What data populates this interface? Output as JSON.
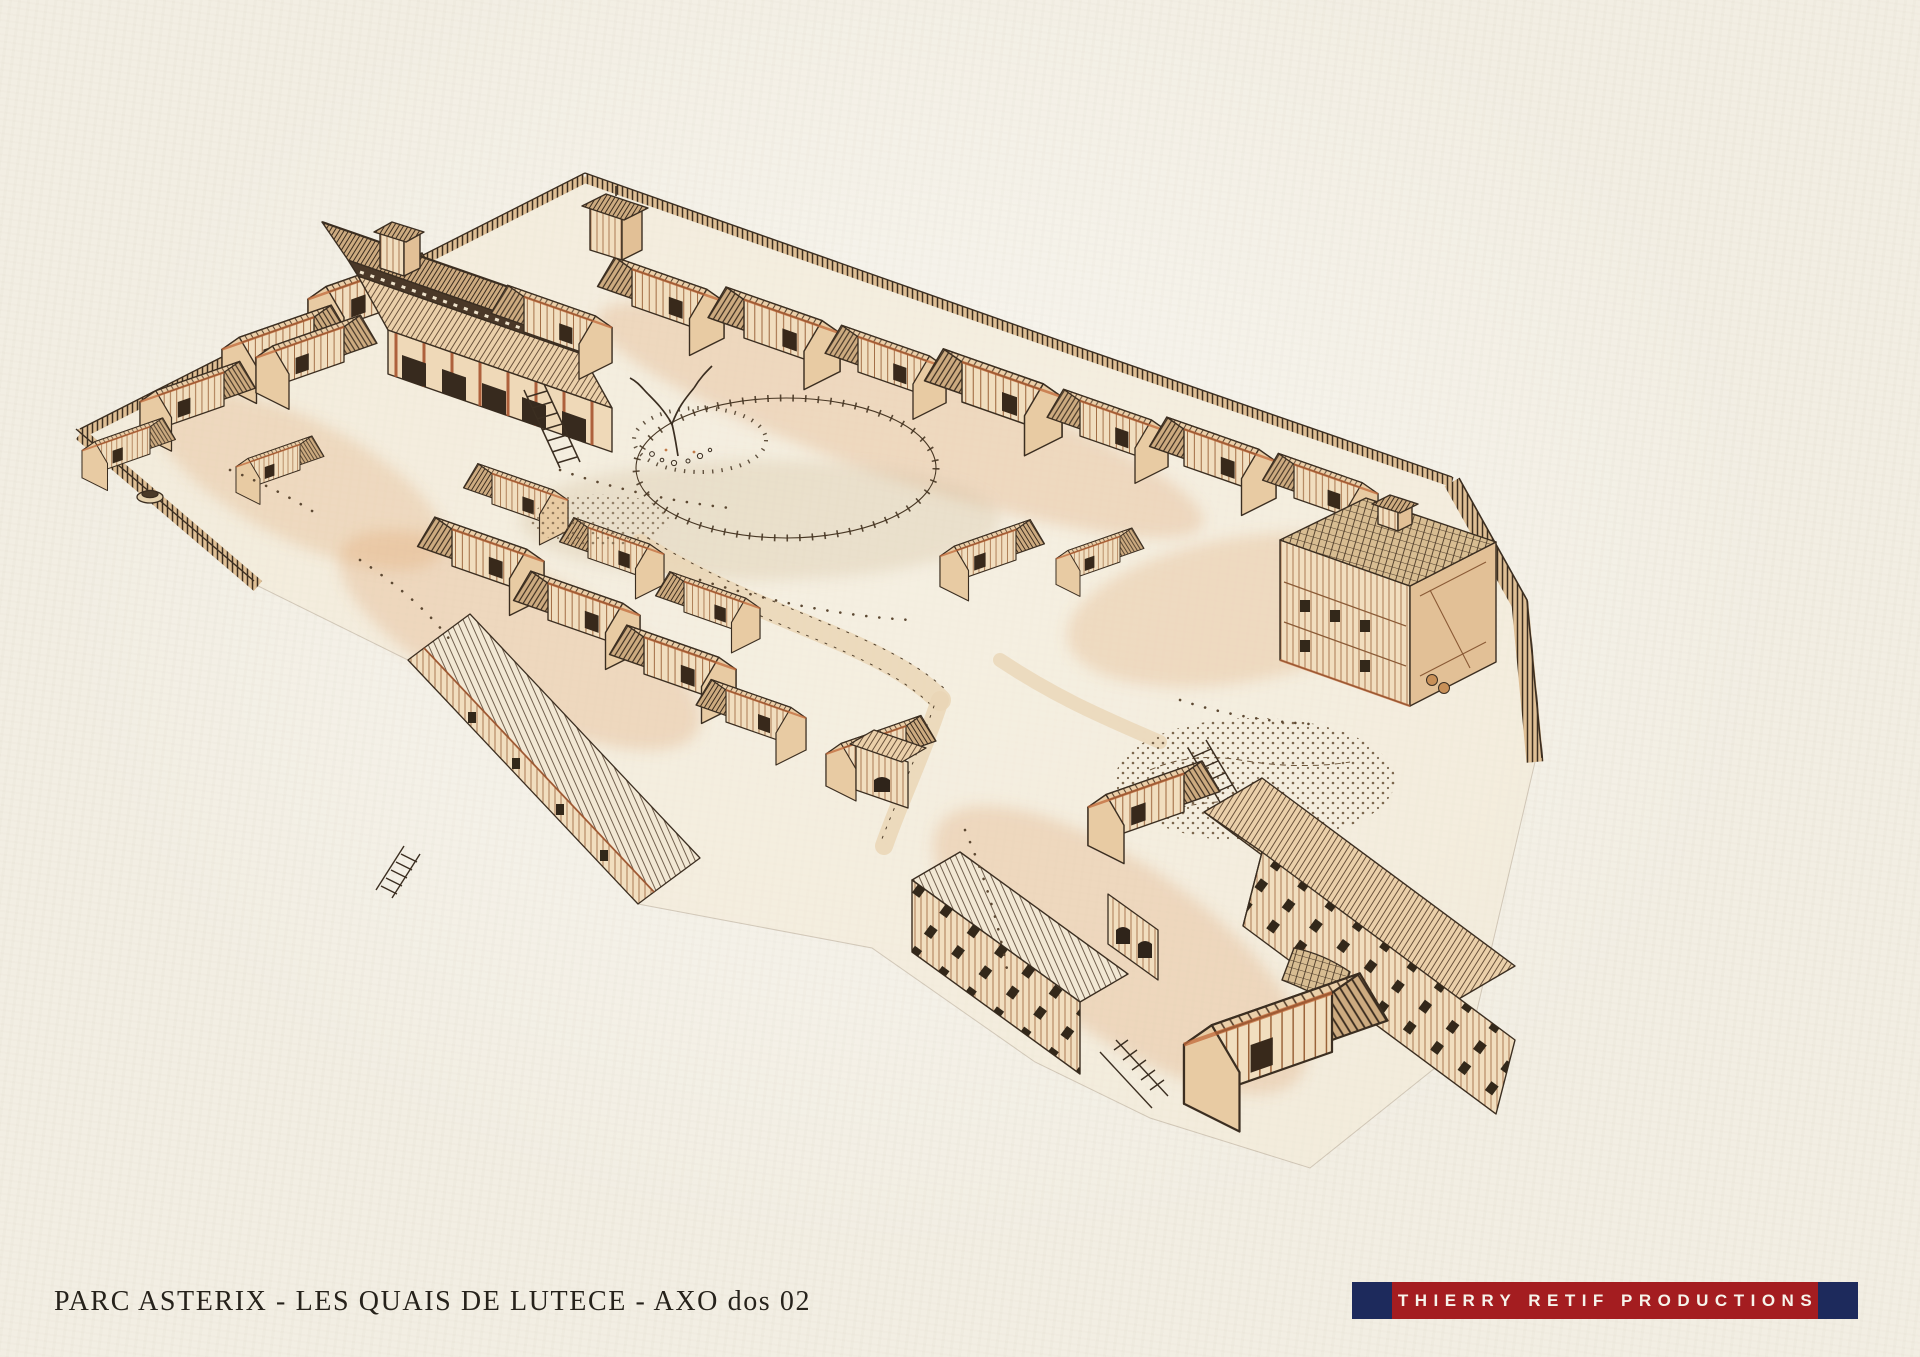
{
  "theme": {
    "paper": "#f2eee3",
    "ink": "#3b2e21",
    "accent": "#c2693a",
    "wash": "#ecd3ae",
    "navy": "#1d2a5c",
    "red": "#a41d20",
    "text": "#26221b",
    "white": "#f6f3ea"
  },
  "caption": {
    "text": "PARC ASTERIX - LES QUAIS DE LUTECE - AXO dos 02"
  },
  "credit_banner": {
    "text": "THIERRY RETIF PRODUCTIONS"
  },
  "illustration": {
    "description": "Hand-drawn sepia ink and sienna-wash axonometric bird's-eye view of the walled Gaulish village enclosure Les Quais de Lutece: timber palisade perimeter, great hall with twin shingled towers, rows of gabled timber houses, central plaza with dead tree and post fence, curved footpaths, rocky garden court, and a long south-east lodging range."
  }
}
